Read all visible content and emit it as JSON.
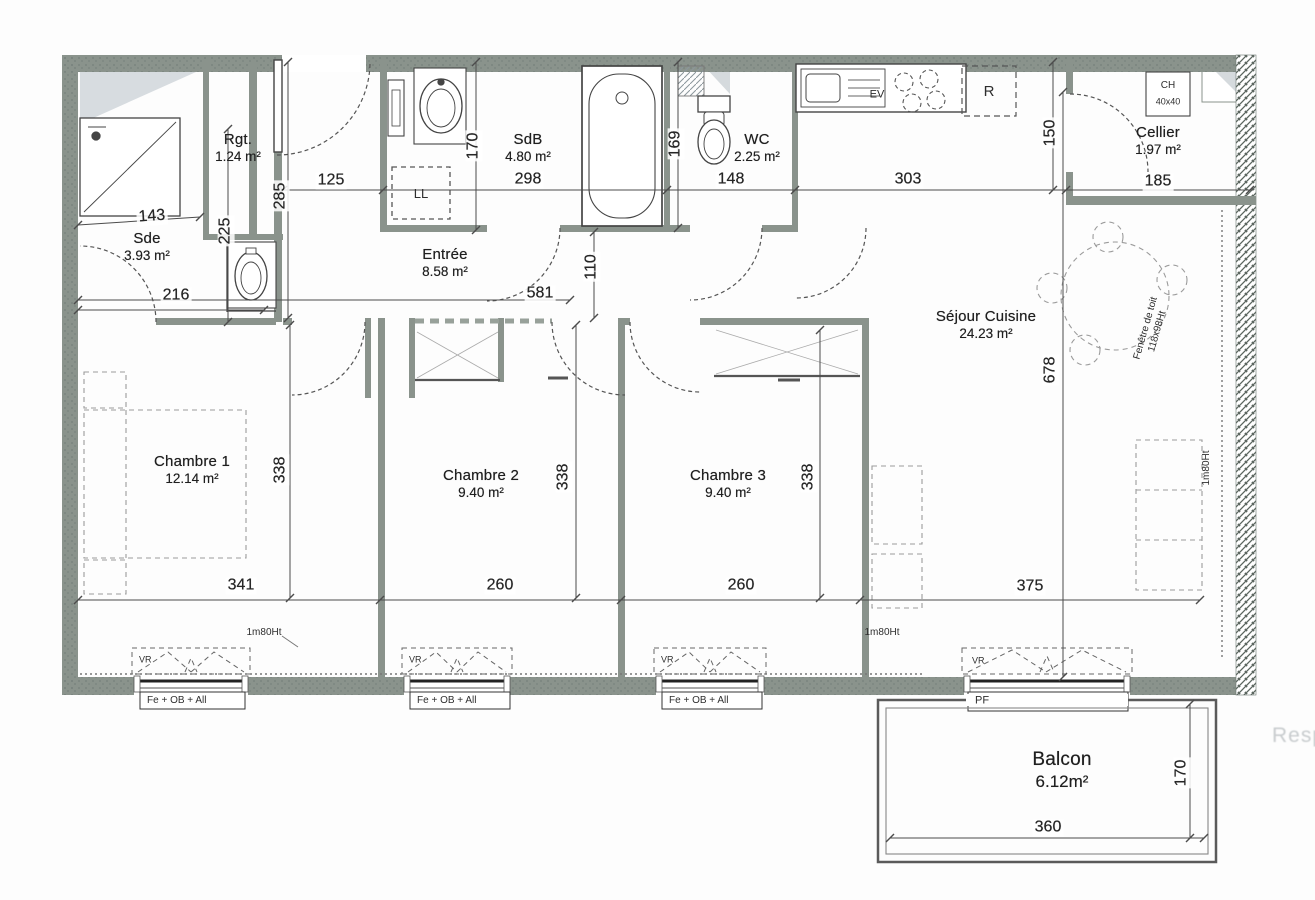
{
  "watermark": {
    "text": "Resp"
  },
  "colors": {
    "wall": "#8a938c",
    "line": "#4a4a4a",
    "furniture_dash": "#999999",
    "slope_fill": "#d7dce0",
    "watermark": "#c8ccce"
  },
  "rooms": [
    {
      "name": "sde",
      "label": "Sde",
      "area": "3.93 m²",
      "x": 147,
      "y": 247
    },
    {
      "name": "rgt",
      "label": "Rgt.",
      "area": "1.24 m²",
      "x": 238,
      "y": 148
    },
    {
      "name": "sdb",
      "label": "SdB",
      "area": "4.80 m²",
      "x": 528,
      "y": 148
    },
    {
      "name": "wc",
      "label": "WC",
      "area": "2.25 m²",
      "x": 757,
      "y": 148
    },
    {
      "name": "entree",
      "label": "Entrée",
      "area": "8.58 m²",
      "x": 445,
      "y": 263
    },
    {
      "name": "cellier",
      "label": "Cellier",
      "area": "1.97 m²",
      "x": 1158,
      "y": 141
    },
    {
      "name": "sejour-cuisine",
      "label": "Séjour Cuisine",
      "area": "24.23 m²",
      "x": 986,
      "y": 325
    },
    {
      "name": "chambre-1",
      "label": "Chambre 1",
      "area": "12.14 m²",
      "x": 192,
      "y": 470
    },
    {
      "name": "chambre-2",
      "label": "Chambre 2",
      "area": "9.40 m²",
      "x": 481,
      "y": 484
    },
    {
      "name": "chambre-3",
      "label": "Chambre 3",
      "area": "9.40 m²",
      "x": 728,
      "y": 484
    },
    {
      "name": "balcon",
      "label": "Balcon",
      "area": "6.12m²",
      "x": 1062,
      "y": 770,
      "big": true
    }
  ],
  "dimensions": [
    {
      "text": "143",
      "x": 152,
      "y": 217,
      "rot": -4
    },
    {
      "text": "225",
      "x": 226,
      "y": 231,
      "rot": -90
    },
    {
      "text": "216",
      "x": 176,
      "y": 296,
      "rot": 0
    },
    {
      "text": "285",
      "x": 281,
      "y": 196,
      "rot": -90
    },
    {
      "text": "125",
      "x": 331,
      "y": 181,
      "rot": 0
    },
    {
      "text": "170",
      "x": 474,
      "y": 146,
      "rot": -90
    },
    {
      "text": "298",
      "x": 528,
      "y": 180,
      "rot": 0
    },
    {
      "text": "169",
      "x": 676,
      "y": 144,
      "rot": -90
    },
    {
      "text": "148",
      "x": 731,
      "y": 180,
      "rot": 0
    },
    {
      "text": "303",
      "x": 908,
      "y": 180,
      "rot": 0
    },
    {
      "text": "150",
      "x": 1051,
      "y": 133,
      "rot": -90
    },
    {
      "text": "185",
      "x": 1158,
      "y": 182,
      "rot": 0
    },
    {
      "text": "581",
      "x": 540,
      "y": 294,
      "rot": 0
    },
    {
      "text": "110",
      "x": 592,
      "y": 267,
      "rot": -90
    },
    {
      "text": "678",
      "x": 1051,
      "y": 370,
      "rot": -90
    },
    {
      "text": "338",
      "x": 281,
      "y": 470,
      "rot": -90
    },
    {
      "text": "338",
      "x": 564,
      "y": 477,
      "rot": -90
    },
    {
      "text": "338",
      "x": 809,
      "y": 477,
      "rot": -90
    },
    {
      "text": "341",
      "x": 241,
      "y": 586,
      "rot": 0
    },
    {
      "text": "260",
      "x": 500,
      "y": 586,
      "rot": 0
    },
    {
      "text": "260",
      "x": 741,
      "y": 586,
      "rot": 0
    },
    {
      "text": "375",
      "x": 1030,
      "y": 587,
      "rot": 0
    },
    {
      "text": "360",
      "x": 1048,
      "y": 828,
      "rot": 0
    },
    {
      "text": "170",
      "x": 1182,
      "y": 773,
      "rot": -90
    }
  ],
  "annotations": [
    {
      "name": "window-label-1",
      "text": "Fe + OB + All",
      "x": 147,
      "y": 701,
      "size": 10,
      "anchor": "left"
    },
    {
      "name": "window-label-2",
      "text": "Fe + OB + All",
      "x": 417,
      "y": 701,
      "size": 10,
      "anchor": "left"
    },
    {
      "name": "window-label-3",
      "text": "Fe + OB + All",
      "x": 669,
      "y": 701,
      "size": 10,
      "anchor": "left"
    },
    {
      "name": "balcony-door-label",
      "text": "PF",
      "x": 975,
      "y": 701,
      "size": 11,
      "anchor": "left"
    },
    {
      "name": "shutter-label-1",
      "text": "VR",
      "x": 139,
      "y": 660,
      "size": 9,
      "anchor": "left"
    },
    {
      "name": "shutter-label-2",
      "text": "VR",
      "x": 409,
      "y": 660,
      "size": 9,
      "anchor": "left"
    },
    {
      "name": "shutter-label-3",
      "text": "VR",
      "x": 661,
      "y": 660,
      "size": 9,
      "anchor": "left"
    },
    {
      "name": "shutter-label-4",
      "text": "VR",
      "x": 972,
      "y": 661,
      "size": 9,
      "anchor": "left"
    },
    {
      "name": "height-line-label-1",
      "text": "1m80Ht",
      "x": 264,
      "y": 633,
      "size": 10
    },
    {
      "name": "height-line-label-2",
      "text": "1m80Ht",
      "x": 882,
      "y": 633,
      "size": 10
    },
    {
      "name": "height-line-label-3",
      "text": "1m80Ht",
      "x": 1207,
      "y": 468,
      "size": 10,
      "rot": -90
    },
    {
      "name": "roof-window-label",
      "text": "Fenêtre de toit\n118x98Ht",
      "x": 1152,
      "y": 330,
      "size": 10,
      "rot": -74
    },
    {
      "name": "water-heater-label",
      "text": "CH",
      "x": 1168,
      "y": 86,
      "size": 10
    },
    {
      "name": "water-heater-size",
      "text": "40x40",
      "x": 1168,
      "y": 102,
      "size": 9
    },
    {
      "name": "washer-slot-label",
      "text": "LL",
      "x": 421,
      "y": 194,
      "size": 13
    },
    {
      "name": "sink-label",
      "text": "EV",
      "x": 877,
      "y": 95,
      "size": 11
    },
    {
      "name": "fridge-label",
      "text": "R",
      "x": 989,
      "y": 92,
      "size": 15
    }
  ]
}
